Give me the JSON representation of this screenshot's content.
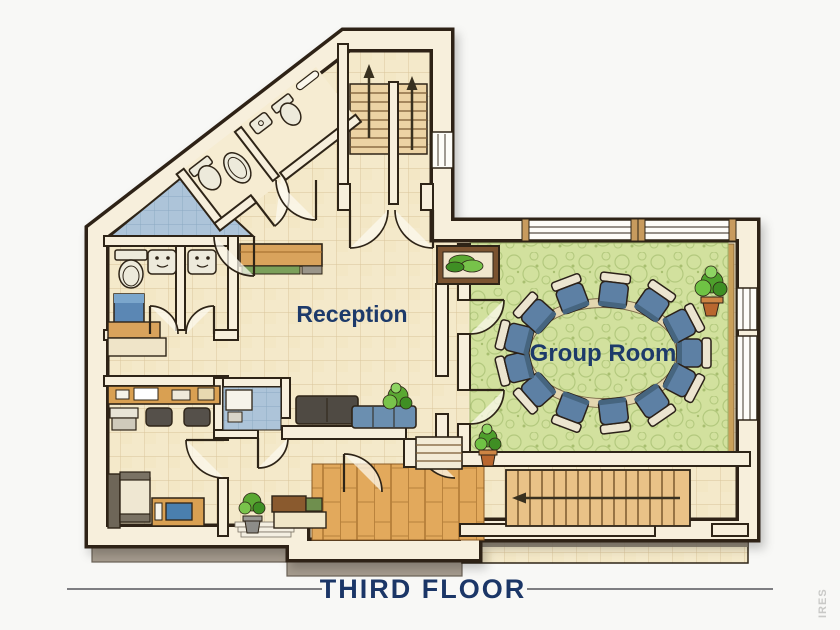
{
  "plan": {
    "title": "THIRD FLOOR",
    "watermark": "IRES",
    "rooms": {
      "reception": {
        "label": "Reception"
      },
      "group_room": {
        "label": "Group Room",
        "chair_count": 13
      }
    },
    "colors": {
      "accent_navy": "#1d3a6a",
      "title_navy": "#1b3667",
      "wall_cream": "#f7efdc",
      "floor_beige": "#f4e9ca",
      "carpet_green": "#d2e19e",
      "chair_blue": "#5d80a4",
      "wood_tan": "#e2a95c",
      "terrace_blue": "#adc4d9",
      "plant_green": "#5aa832",
      "pot_terracotta": "#b9672f",
      "foundation_gray": "#a69c8e"
    }
  }
}
